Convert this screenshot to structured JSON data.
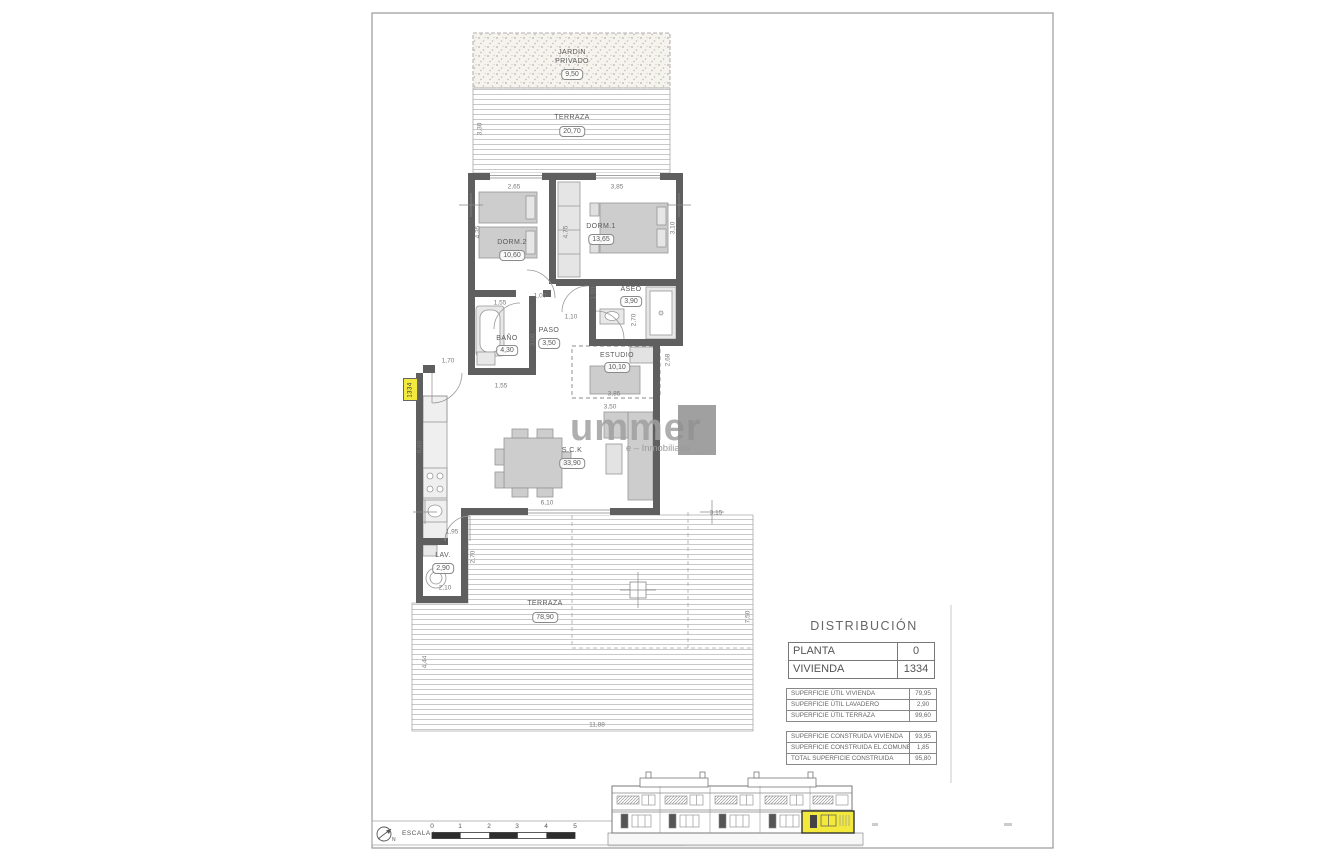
{
  "sheet": {
    "title_block": {
      "title": "DISTRIBUCIÓN",
      "info_rows": [
        {
          "label": "PLANTA",
          "value": "0"
        },
        {
          "label": "VIVIENDA",
          "value": "1334"
        }
      ],
      "util_rows": [
        {
          "label": "SUPERFICIE ÚTIL VIVIENDA",
          "value": "79,95"
        },
        {
          "label": "SUPERFICIE ÚTIL LAVADERO",
          "value": "2,90"
        },
        {
          "label": "SUPERFICIE ÚTIL TERRAZA",
          "value": "99,60"
        }
      ],
      "construida_rows": [
        {
          "label": "SUPERFICIE CONSTRUIDA VIVIENDA",
          "value": "93,95"
        },
        {
          "label": "SUPERFICIE CONSTRUIDA EL.COMUNES",
          "value": "1,85"
        },
        {
          "label": "TOTAL SUPERFICIE CONSTRUIDA",
          "value": "95,80"
        }
      ]
    },
    "scale": {
      "label": "ESCALA :",
      "north": "N",
      "ticks": [
        "0",
        "1",
        "2",
        "3",
        "4",
        "5"
      ]
    },
    "watermark": {
      "big": "ummer",
      "small": "e – Inmobiliaria –"
    }
  },
  "plan": {
    "unit_tag": "1334",
    "rooms": {
      "jardin": {
        "name": "JARDIN",
        "name2": "PRIVADO",
        "area": "9,50"
      },
      "terraza_top": {
        "name": "TERRAZA",
        "area": "20,70"
      },
      "dorm2": {
        "name": "DORM.2",
        "area": "10,60"
      },
      "dorm1": {
        "name": "DORM.1",
        "area": "13,65"
      },
      "aseo": {
        "name": "ASEO",
        "area": "3,90"
      },
      "bano": {
        "name": "BAÑO",
        "area": "4,30"
      },
      "paso": {
        "name": "PASO",
        "area": "3,50"
      },
      "estudio": {
        "name": "ESTUDIO",
        "area": "10,10"
      },
      "sck": {
        "name": "S.C.K",
        "area": "33,90"
      },
      "lav": {
        "name": "LAV.",
        "area": "2,90"
      },
      "terraza": {
        "name": "TERRAZA",
        "area": "78,90"
      }
    },
    "dims": {
      "w_dorm2": "2,65",
      "w_dorm1": "3,85",
      "h_dorm2": "4,35",
      "h_dorm1": "3,10",
      "closet": "4,75",
      "pass_a": "1,00",
      "dorm2_door": "1,55",
      "aseo_a": "1,50",
      "aseo_b": "2,70",
      "aseo_door": "1,10",
      "paso_h": "3,00",
      "bano_w": "1,55",
      "estudio_a": "3,85",
      "estudio_b": "3,50",
      "estudio_h": "2,68",
      "sck_w": "6,10",
      "kitchen": "0,80",
      "entrance": "1,70",
      "lav_a": "1,95",
      "lav_b": "2,10",
      "lav_c": "2,70",
      "terr_top_h": "3,30",
      "terr_a": "3,15",
      "terr_right": "7,50",
      "terr_left": "4,44",
      "terr_bottom": "11,88"
    }
  },
  "colors": {
    "wall": "#5f5f5f",
    "highlight": "#f2e93c"
  }
}
